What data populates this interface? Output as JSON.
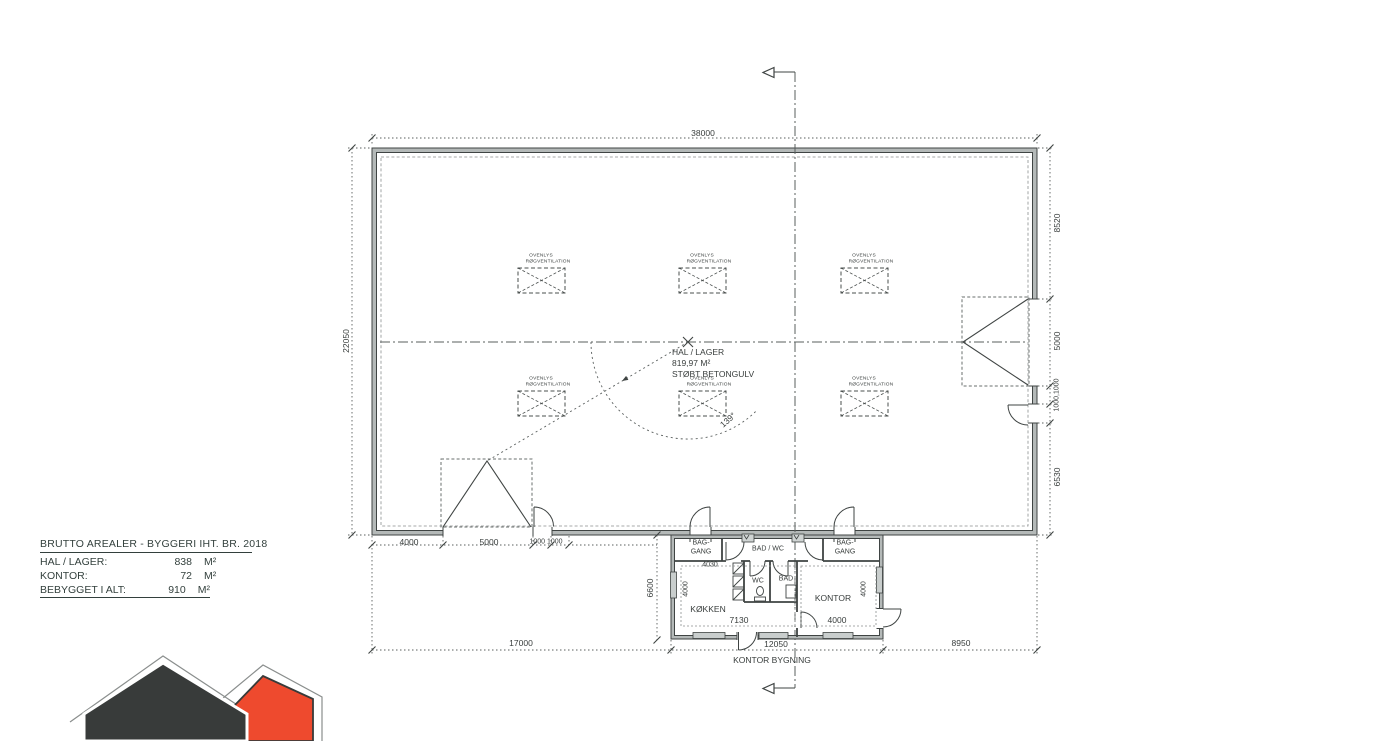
{
  "colors": {
    "line": "#3f4443",
    "brand_dark": "#383b3a",
    "brand_orange": "#ee4a2e"
  },
  "area_table": {
    "title": "BRUTTO AREALER - BYGGERI IHT. BR. 2018",
    "rows": [
      {
        "label": "HAL / LAGER:",
        "value": "838",
        "unit": "M²"
      },
      {
        "label": "KONTOR:",
        "value": "72",
        "unit": "M²"
      },
      {
        "label": "BEBYGGET I ALT:",
        "value": "910",
        "unit": "M²"
      }
    ]
  },
  "plan": {
    "hall": {
      "name": "HAL / LAGER",
      "area": "819,97 M²",
      "floor": "STØBT BETONGULV",
      "angle": "139°",
      "skylight_line1": "OVENLYS",
      "skylight_line2": "RØGVENTILATION"
    },
    "office": {
      "caption": "KONTOR BYGNING",
      "rooms": {
        "bag_gang_l1": "BAG-",
        "bag_gang_l2": "GANG",
        "bad_wc": "BAD / WC",
        "wc": "WC",
        "bad": "BAD",
        "kokken": "KØKKEN",
        "kontor": "KONTOR"
      },
      "dims": {
        "entry_width": "4030",
        "kokken_width": "7130",
        "kontor_width": "4000",
        "kokken_depth": "4000",
        "kontor_depth": "4000",
        "depth": "6600",
        "width": "12050"
      }
    },
    "dims": {
      "top_width": "38000",
      "left_height": "22050",
      "right_top": "8520",
      "right_gate": "5000",
      "right_doors": "1000,1000",
      "right_bottom": "6530",
      "bottom_seg1": "4000",
      "bottom_seg2": "5000",
      "bottom_seg3": "1000 1000",
      "total_left": "17000",
      "total_right": "8950"
    }
  }
}
